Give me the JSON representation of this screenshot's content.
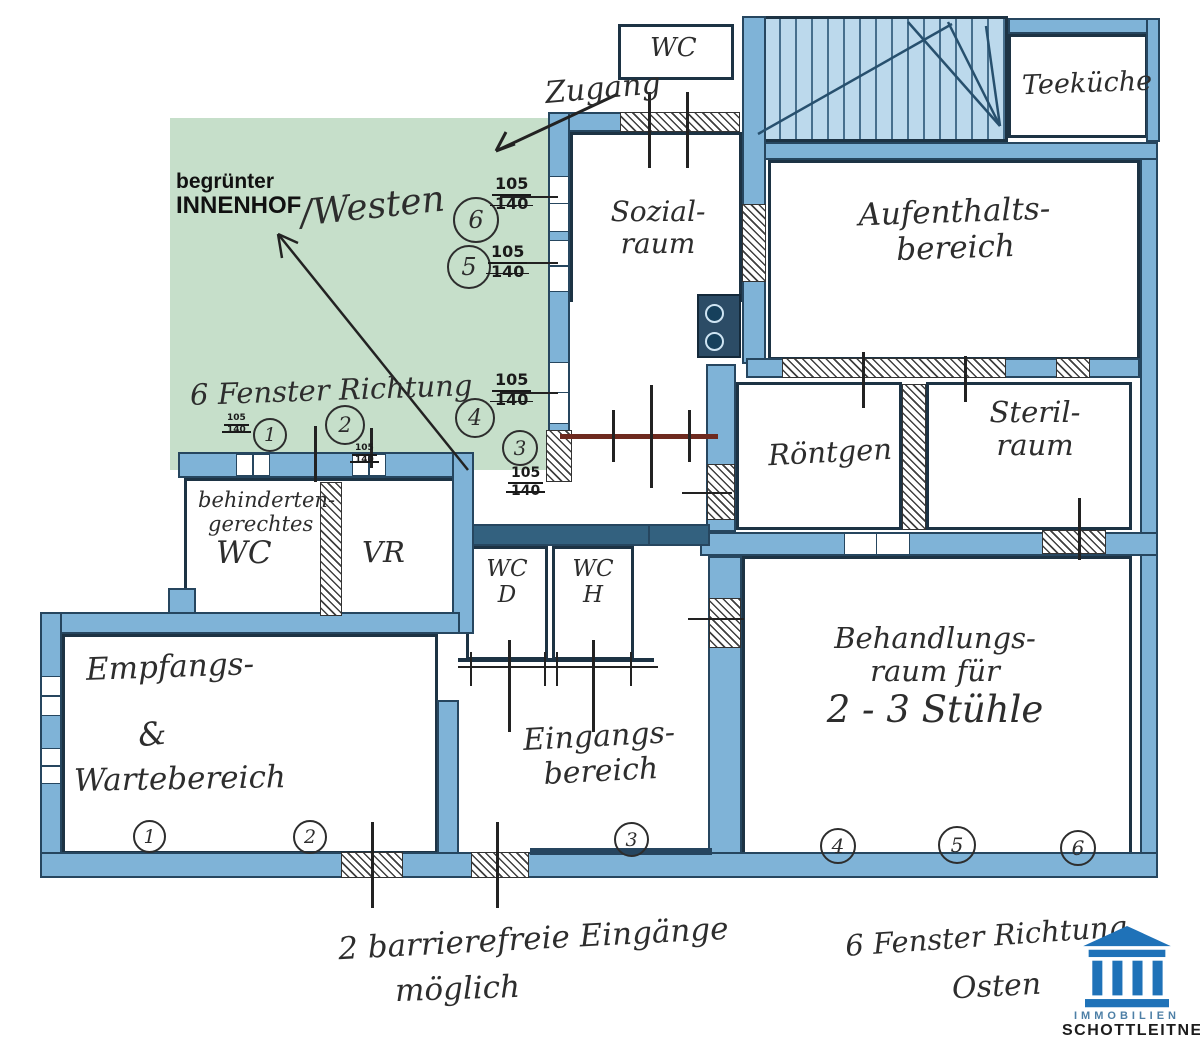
{
  "colors": {
    "wall_blue": "#7fb3d7",
    "wall_dark": "#33617f",
    "outline": "#1d3344",
    "courtyard_green": "#c6dfca",
    "ink": "#2d2d2d",
    "markup_red": "#6e2a1f",
    "logo_blue": "#1f72b8"
  },
  "top": {
    "zugang": "Zugang",
    "wc": "WC",
    "teekueche": "Teeküche"
  },
  "courtyard": {
    "l1": "begrünter",
    "l2": "INNENHOF",
    "westen": "/Westen",
    "fenster": "6 Fenster Richtung"
  },
  "rooms": {
    "sozialraum": {
      "l1": "Sozial-",
      "l2": "raum"
    },
    "aufenthalt": {
      "l1": "Aufenthalts-",
      "l2": "bereich"
    },
    "roentgen": {
      "l1": "Röntgen"
    },
    "steril": {
      "l1": "Steril-",
      "l2": "raum"
    },
    "behandlung": {
      "l1": "Behandlungs-",
      "l2": "raum für",
      "l3": "2 - 3 Stühle"
    },
    "wc_beh": {
      "l1": "behinderten-",
      "l2": "gerechtes",
      "l3": "WC"
    },
    "vr": {
      "l1": "VR"
    },
    "wc_d": {
      "l1": "WC",
      "l2": "D"
    },
    "wc_h": {
      "l1": "WC",
      "l2": "H"
    },
    "empfang": {
      "l1": "Empfangs-",
      "l2": "&",
      "l3": "Wartebereich"
    },
    "eingang": {
      "l1": "Eingangs-",
      "l2": "bereich"
    }
  },
  "windows_west": [
    {
      "n": "6",
      "a": "105",
      "b": "140"
    },
    {
      "n": "5",
      "a": "105",
      "b": "140"
    },
    {
      "n": "4",
      "a": "105",
      "b": "140"
    },
    {
      "n": "3",
      "a": "105",
      "b": "140"
    }
  ],
  "windows_small": [
    {
      "n": "1",
      "a": "105",
      "b": "140"
    },
    {
      "n": "2",
      "a": "105",
      "b": "140"
    }
  ],
  "entrance_markers": {
    "m1": "1",
    "m2": "2",
    "m3": "3",
    "m4": "4",
    "m5": "5",
    "m6": "6"
  },
  "notes": {
    "barrier1": "2 barrierefreie Eingänge",
    "barrier2": "möglich",
    "ost1": "6 Fenster Richtung",
    "ost2": "Osten"
  },
  "logo": {
    "line1": "IMMOBILIEN",
    "line2": "SCHOTTLEITNER"
  }
}
